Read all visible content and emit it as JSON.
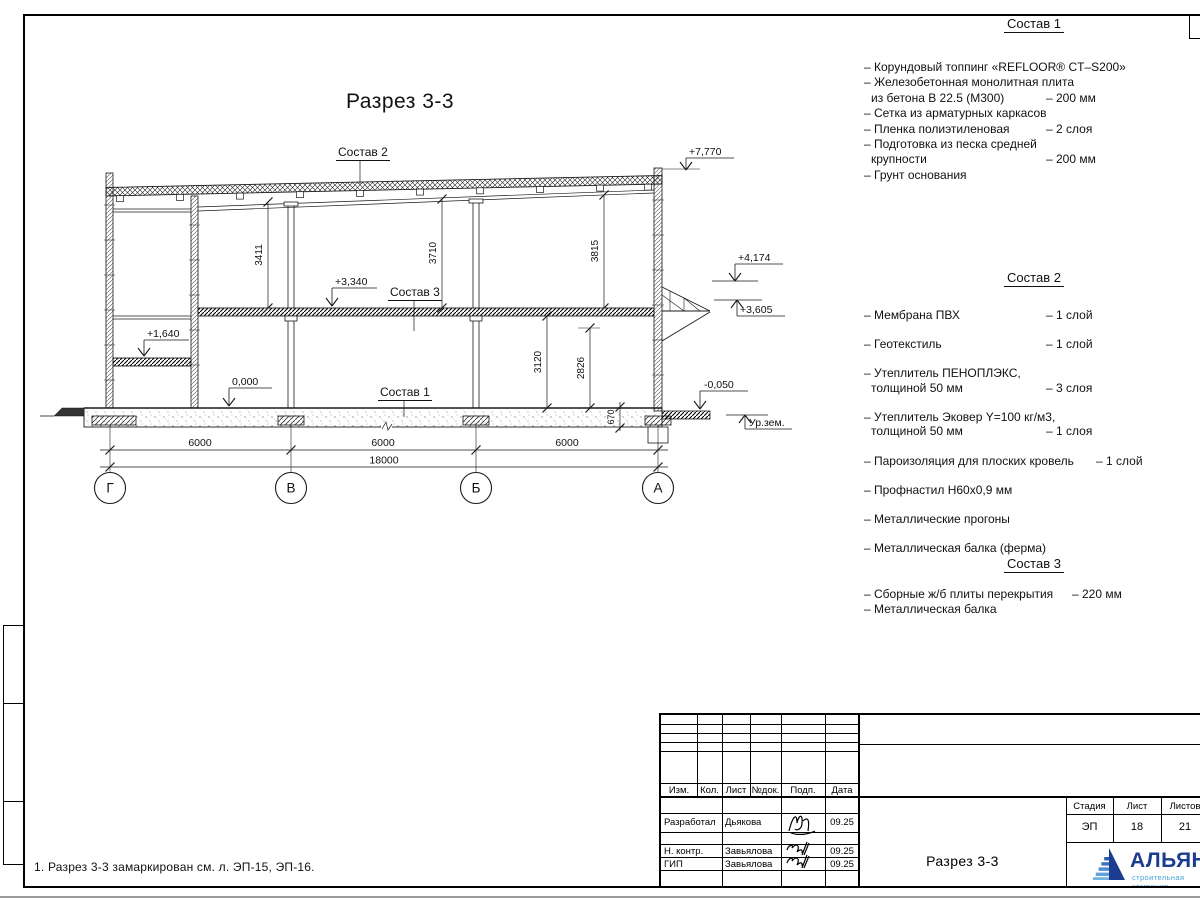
{
  "sheet": {
    "drawing_title": "Разрез 3-3",
    "note": "1. Разрез 3-3 замаркирован см. л. ЭП-15, ЭП-16."
  },
  "drawing": {
    "axes": [
      "Г",
      "В",
      "Б",
      "А"
    ],
    "span_dims": [
      "6000",
      "6000",
      "6000"
    ],
    "total_dim": "18000",
    "vdims": [
      "3411",
      "3710",
      "3815",
      "3120",
      "2826",
      "670"
    ],
    "levels": {
      "roof": "+7,770",
      "canopy_top": "+4,174",
      "canopy_edge": "+3,605",
      "slab": "+3,340",
      "mezzanine": "+1,640",
      "floor": "0,000",
      "entry": "-0,050",
      "ground": "Ур.зем."
    },
    "refs": {
      "s1": "Состав 1",
      "s2": "Состав 2",
      "s3": "Состав 3"
    }
  },
  "lists": [
    {
      "title": "Состав 1",
      "items": [
        {
          "rows": [
            {
              "text": "– Корундовый топпинг «REFLOOR® CT–S200»",
              "value": ""
            }
          ]
        },
        {
          "rows": [
            {
              "text": "– Железобетонная  монолитная плита",
              "value": ""
            },
            {
              "text": "из бетона В 22.5 (М300)",
              "value": "– 200 мм"
            }
          ]
        },
        {
          "rows": [
            {
              "text": "– Сетка из арматурных каркасов",
              "value": ""
            }
          ]
        },
        {
          "rows": [
            {
              "text": "– Пленка полиэтиленовая",
              "value": "– 2 слоя"
            }
          ]
        },
        {
          "rows": [
            {
              "text": "– Подготовка из песка средней",
              "value": ""
            },
            {
              "text": "крупности",
              "value": "– 200 мм"
            }
          ]
        },
        {
          "rows": [
            {
              "text": "– Грунт основания",
              "value": ""
            }
          ]
        }
      ]
    },
    {
      "title": "Состав 2",
      "items": [
        {
          "rows": [
            {
              "text": "– Мембрана ПВХ",
              "value": "– 1 слой"
            }
          ]
        },
        {
          "rows": [
            {
              "text": "– Геотекстиль",
              "value": "– 1 слой"
            }
          ]
        },
        {
          "rows": [
            {
              "text": "– Утеплитель ПЕНОПЛЭКС,",
              "value": ""
            },
            {
              "text": "толщиной 50 мм",
              "value": "– 3 слоя"
            }
          ]
        },
        {
          "rows": [
            {
              "text": "– Утеплитель Эковер Y=100 кг/м3,",
              "value": ""
            },
            {
              "text": "толщиной 50 мм",
              "value": "– 1 слоя"
            }
          ]
        },
        {
          "rows": [
            {
              "text": "– Пароизоляция для плоских кровель",
              "value": "– 1 слой"
            }
          ]
        },
        {
          "rows": [
            {
              "text": "– Профнастил Н60х0,9 мм",
              "value": ""
            }
          ]
        },
        {
          "rows": [
            {
              "text": "– Металлические прогоны",
              "value": ""
            }
          ]
        },
        {
          "rows": [
            {
              "text": "– Металлическая балка (ферма)",
              "value": ""
            }
          ]
        }
      ]
    },
    {
      "title": "Состав 3",
      "items": [
        {
          "rows": [
            {
              "text": "– Сборные ж/б плиты перекрытия",
              "value": "– 220 мм"
            }
          ]
        },
        {
          "rows": [
            {
              "text": "– Металлическая балка",
              "value": ""
            }
          ]
        }
      ]
    }
  ],
  "titleblock": {
    "cols": [
      "Изм.",
      "Кол.",
      "Лист",
      "№док.",
      "Подп.",
      "Дата"
    ],
    "rows": [
      {
        "role": "Разработал",
        "name": "Дьякова",
        "date": "09.25"
      },
      {
        "role": "Н. контр.",
        "name": "Завьялова",
        "date": "09.25"
      },
      {
        "role": "ГИП",
        "name": "Завьялова",
        "date": "09.25"
      }
    ],
    "doc_title": "Разрез 3-3",
    "stadia_label": "Стадия",
    "list_label": "Лист",
    "lists_label": "Листов",
    "stadia": "ЭП",
    "list_no": "18",
    "lists_total": "21"
  },
  "logo": {
    "name": "АЛЬЯНС",
    "subtitle": "строительная компания",
    "color": "#1c3d8f",
    "accent": "#4aa0d6"
  }
}
